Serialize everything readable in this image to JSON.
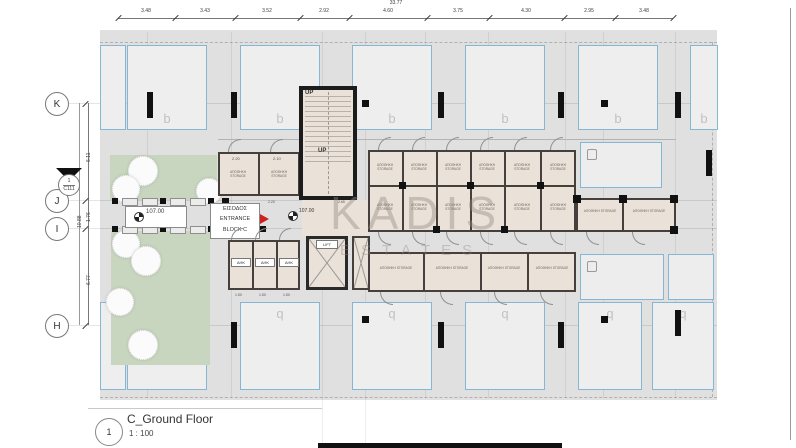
{
  "title_block": {
    "view_number": "1",
    "title": "C_Ground Floor",
    "scale": "1 : 100"
  },
  "watermark": {
    "line1": "KADIS",
    "line2": "ESTATES"
  },
  "grid": {
    "rows": [
      "K",
      "J",
      "I",
      "H"
    ],
    "section_marker": {
      "number": "1",
      "label": "C111"
    }
  },
  "dimensions": {
    "overall_top": "33.77",
    "top": [
      "3.48",
      "3.43",
      "3.52",
      "2.92",
      "4.60",
      "3.75",
      "4.30",
      "2.95",
      "3.48"
    ],
    "left": [
      "6.11",
      "1.76",
      "6.77"
    ],
    "left_overall": "10.88",
    "room_dims": {
      "storage_left_a": "2.20",
      "storage_left_b": "2.10",
      "hall_width": "2.20",
      "hall_depth": "2.65",
      "ahk_width": "1.50"
    }
  },
  "labels": {
    "entrance": {
      "line1": "ΕΙΣΟΔΟΣ",
      "line2": "ENTRANCE",
      "line3": "BLOCK C"
    },
    "level": "107.00",
    "up": "UP",
    "lift": "LIFT",
    "ahk": "AHK",
    "storage": "ΑΠΟΘΗΚΗ STORAGE",
    "parking_top": "b",
    "parking_bottom": "q"
  },
  "colors": {
    "accent_blue": "#85b7d4",
    "landscape_green": "#c8d5bf",
    "room_beige": "#eae1d8",
    "wall_dark": "#45403c",
    "entrance_red": "#cc2222",
    "plan_gray": "#e0e0e0"
  }
}
